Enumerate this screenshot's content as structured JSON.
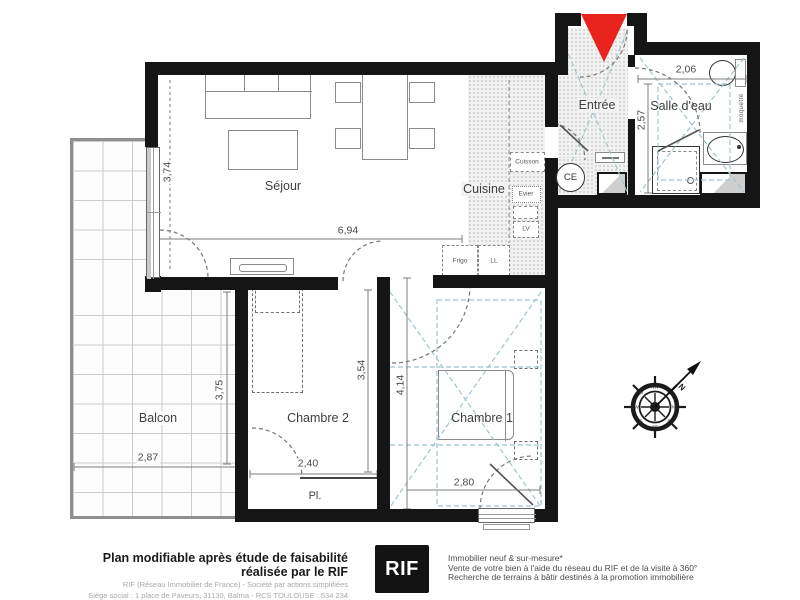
{
  "rooms": {
    "sejour": "Séjour",
    "cuisine": "Cuisine",
    "entree": "Entrée",
    "salle_deau": "Salle d'eau",
    "balcon": "Balcon",
    "chambre1": "Chambre 1",
    "chambre2": "Chambre 2",
    "placard": "Pl."
  },
  "dims": {
    "sejour_w": "6,94",
    "sejour_h": "3,74",
    "balcon_w": "2,87",
    "balcon_h": "3,75",
    "chambre2_w": "2,40",
    "chambre2_h": "3,54",
    "chambre1_w": "2,80",
    "chambre1_h": "4,14",
    "sdb_w": "2,06",
    "sdb_h": "2,57"
  },
  "labels": {
    "cuisson": "Cuisson",
    "evier": "Evier",
    "lv": "LV",
    "frigo": "Frigo",
    "ll": "LL",
    "ce": "CE",
    "moquette": "moquette",
    "north": "N"
  },
  "compass": {
    "points": [
      "N",
      "NE",
      "E",
      "SE",
      "S",
      "SW",
      "W",
      "NW"
    ]
  },
  "colors": {
    "wall": "#151515",
    "arrow_red": "#e8231d",
    "blue_dash": "#a0c4cf",
    "logo_bg": "#121212"
  },
  "footer": {
    "tagline": "Plan modifiable après étude de faisabilité réalisée par le RIF",
    "legal1": "RIF (Réseau Immobilier de France) - Société par actions simplifiées",
    "legal2": "Siège social : 1 place de Paveurs, 31130, Balma - RCS TOULOUSE : 534 234 174",
    "logo": "RIF",
    "services1": "Immobilier neuf & sur-mesure*",
    "services2": "Vente de votre bien à l'aide du réseau du RIF et de la visite à 360°",
    "services3": "Recherche de terrains à bâtir destinés à la promotion immobilière"
  }
}
